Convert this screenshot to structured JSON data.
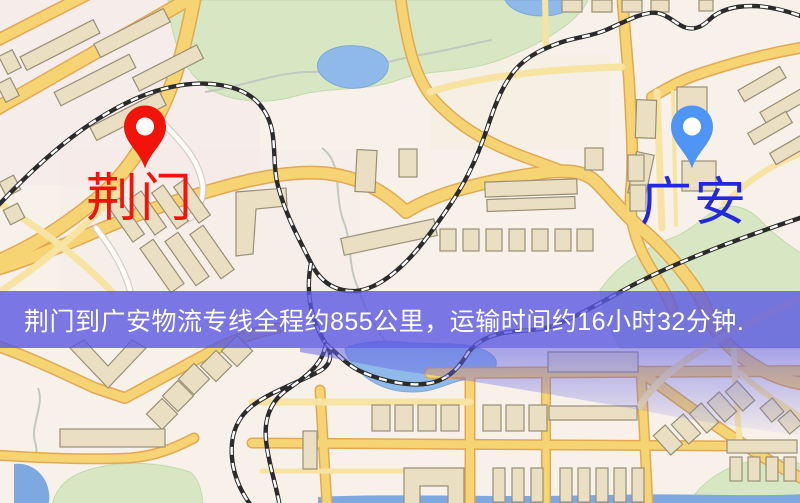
{
  "map": {
    "origin_marker": {
      "label": "荆门",
      "pin_color": "#f2140a",
      "label_color": "#f2140a"
    },
    "destination_marker": {
      "label": "广安",
      "pin_color": "#4e95f5",
      "label_color": "#2428dd"
    },
    "banner": {
      "text": "荆门到广安物流专线全程约855公里，运输时间约16小时32分钟.",
      "background_color": "#5a58e2",
      "text_color": "#ffffff"
    },
    "route_info": {
      "origin": "荆门",
      "destination": "广安",
      "distance_km": 855,
      "duration_hours": 16,
      "duration_minutes": 32
    }
  },
  "colors": {
    "map_background": "#f7f1ea",
    "road_major": "#f6d373",
    "road_casing": "#e2a952",
    "road_pale": "#f7e3a2",
    "park_green": "#d8e7c3",
    "water_blue": "#8fb9e8",
    "building_tan": "#eadfc2",
    "railway_black": "#2b2b2b"
  }
}
